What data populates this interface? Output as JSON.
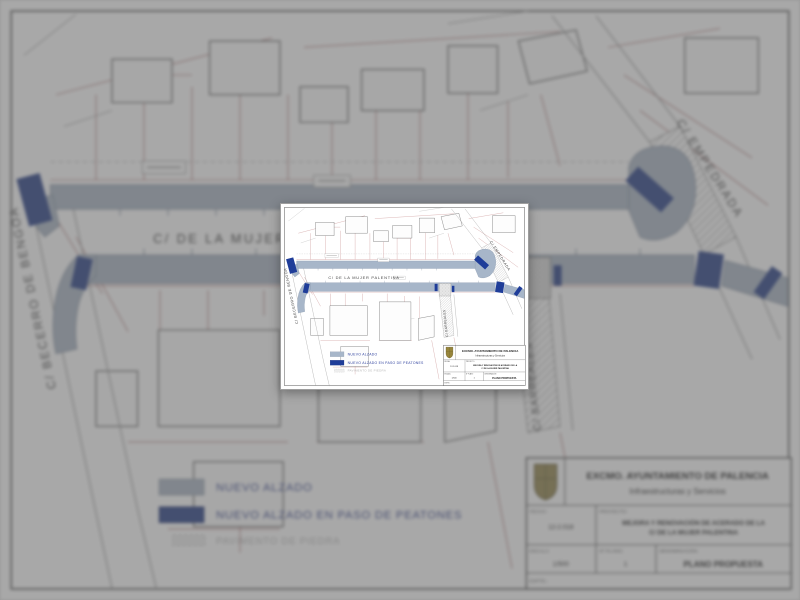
{
  "sheet": {
    "streets": {
      "main": "C/ DE LA MUJER PALENTINA",
      "left_diagonal": "C/ BECERRO DE BENGOA",
      "top_right_diagonal": "C/ EMPEDRADA",
      "bottom_vertical": "C/ BARREALES"
    },
    "legend": {
      "items": [
        {
          "label": "NUEVO ALZADO",
          "swatch_color": "#a7b6c9"
        },
        {
          "label": "NUEVO ALZADO EN PASO DE PEATONES",
          "swatch_color": "#1f3d99"
        },
        {
          "label": "PAVIMENTO DE PIEDRA",
          "swatch_color": "#eeeeee"
        }
      ]
    },
    "title_block": {
      "org_name": "EXCMO. AYUNTAMIENTO DE PALENCIA",
      "org_dept": "Infraestructuras y Servicios",
      "fecha_label": "FECHA:",
      "fecha_value": "12-2.018",
      "proyecto_label": "PROYECTO:",
      "title_line1": "MEJORA Y RENOVACIÓN DE ACERADO DE LA",
      "title_line2": "C/ DE LA MUJER PALENTINA",
      "escala_label": "ESCALA:",
      "escala_value": "1/500",
      "plano_num_label": "Nº PLANO:",
      "plano_num_value": "1",
      "denominacion_label": "DENOMINACIÓN:",
      "denominacion_value": "PLANO PROPUESTA",
      "expediente_label": "EXPTE.:"
    }
  },
  "colors": {
    "sidewalk_fill": "#a7b6c9",
    "sidewalk_edge": "#7c8ba3",
    "crosswalk_fill": "#1f3d99",
    "parcel_line": "#b26262",
    "building_line": "#5a5a5a",
    "legend_text": "#3345a0",
    "street_text": "#3f3f3f"
  }
}
